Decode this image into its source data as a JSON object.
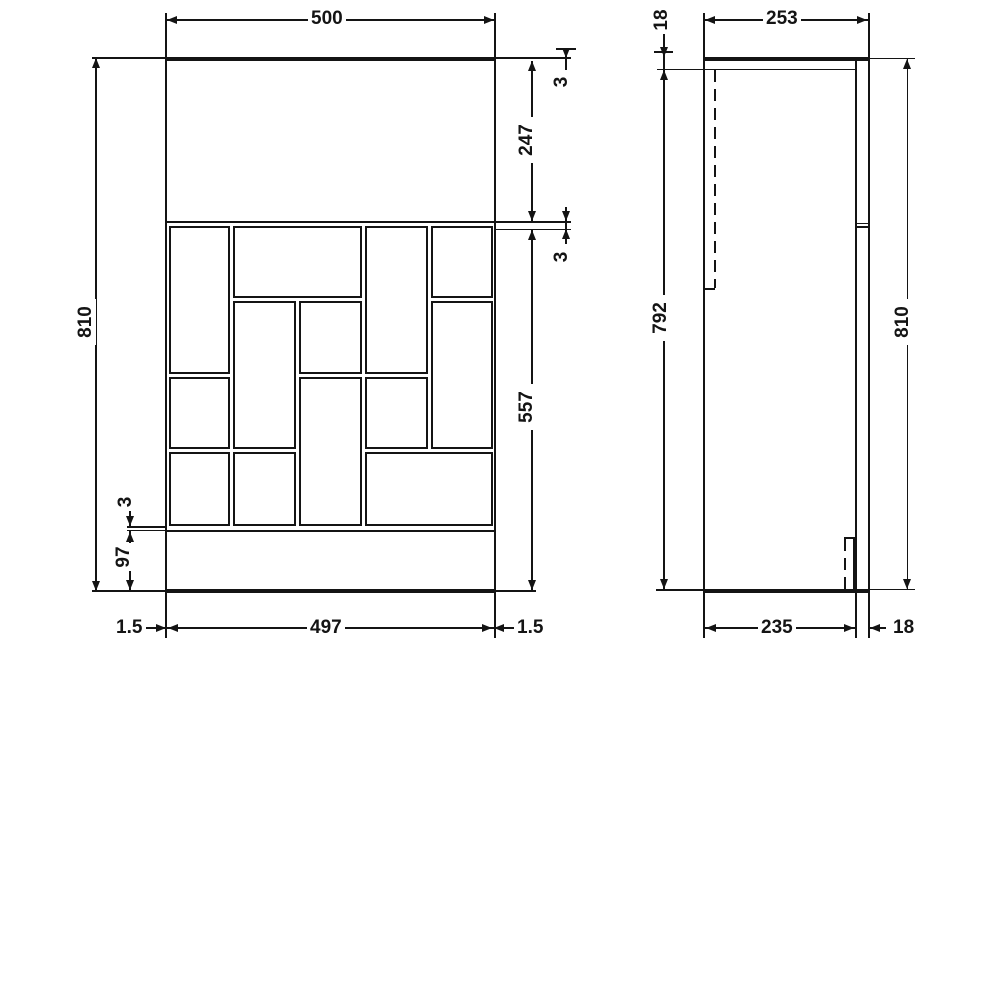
{
  "front_view": {
    "dim_width_top": "500",
    "dim_height_left": "810",
    "dim_top_gap": "3",
    "dim_door_height": "247",
    "dim_mid_gap": "3",
    "dim_lower_height": "557",
    "dim_plinth_gap": "3",
    "dim_plinth_height": "97",
    "dim_bottom_left_edge": "1.5",
    "dim_width_bottom": "497",
    "dim_bottom_right_edge": "1.5",
    "brick_grid_x": [
      167,
      231.5,
      297.5,
      363.5,
      429,
      494
    ],
    "brick_grid_y": [
      224,
      299.5,
      375,
      450.5,
      527
    ],
    "bricks": [
      [
        0,
        1,
        0,
        2
      ],
      [
        1,
        3,
        0,
        1
      ],
      [
        3,
        4,
        0,
        2
      ],
      [
        4,
        5,
        0,
        1
      ],
      [
        1,
        2,
        1,
        3
      ],
      [
        2,
        3,
        1,
        2
      ],
      [
        4,
        5,
        1,
        3
      ],
      [
        0,
        1,
        2,
        3
      ],
      [
        2,
        3,
        2,
        4
      ],
      [
        3,
        4,
        2,
        3
      ],
      [
        0,
        1,
        3,
        4
      ],
      [
        1,
        2,
        3,
        4
      ],
      [
        3,
        5,
        3,
        4
      ]
    ]
  },
  "side_view": {
    "dim_top_thickness": "18",
    "dim_depth_top": "253",
    "dim_body_height": "792",
    "dim_height_right": "810",
    "dim_depth_bottom": "235",
    "dim_back_panel": "18"
  },
  "colors": {
    "ink": "#141414",
    "paper": "#ffffff"
  }
}
